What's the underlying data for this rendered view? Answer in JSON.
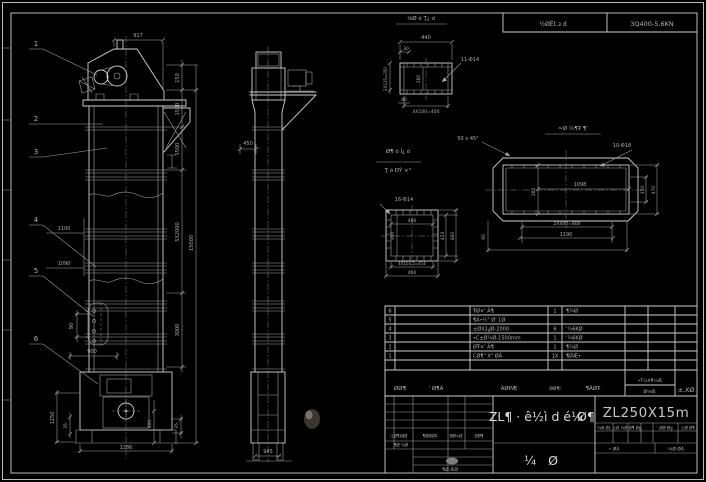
{
  "sheet": {
    "stamp": {
      "label": "½ØЁt.з d",
      "value": "3Q400-5.6KN"
    }
  },
  "front_view": {
    "balloons": [
      "1",
      "2",
      "3",
      "4",
      "5",
      "6"
    ],
    "dims": {
      "w917": "917",
      "h150": "150",
      "h1500a": "1500",
      "h1500b": "1500",
      "h5x2000": "5X2000",
      "h3000": "3000",
      "h15000": "15000",
      "d1100": "1100",
      "d1090": "1090",
      "d90": "90",
      "d900": "900",
      "d1250": "1250",
      "d35l": "35",
      "d1286": "1286",
      "d400": "400",
      "d35r": "35"
    }
  },
  "side_view": {
    "dims": {
      "d450": "450",
      "d945": "945"
    }
  },
  "channel_detail": {
    "title": "⅛Ø ó Ţ¿ d",
    "holes": "11-Φ14",
    "dims": {
      "d440": "440",
      "d30": "30",
      "d2x125": "2X125=250",
      "d260": "260",
      "d40": "40",
      "d4x100": "4X100=400"
    }
  },
  "flange_detail": {
    "label_top": "Ø¶ ó Ì¿ ó",
    "label_bottom": "Ţ ó ĐÝ ×°",
    "holes": "16-Φ14",
    "dims": {
      "d400": "400",
      "d390": "390",
      "d413": "413",
      "d460r": "460",
      "d4x1035": "4X103.5=414",
      "d460b": "460"
    }
  },
  "cover_detail": {
    "title": "≈Ø ½¶Ŧ ¶'",
    "chamfer": "50 x 45°",
    "holes": "10-Φ18",
    "dims": {
      "d1098": "1098",
      "d382": "382",
      "d150": "150",
      "d470": "470",
      "d2x400": "2X400=800",
      "d1190": "1190",
      "d95": "95"
    }
  },
  "bom": {
    "headers": {
      "h1": "ØØ¶",
      "h2": "' Ø¶Ã",
      "h3": "ÃØPÆ",
      "h4": "ØØ¶l",
      "h5": "¶ÃØŦ",
      "h6a": "•Ŧ¼X¶¼Æ",
      "h6b": "Ø¼Ø,",
      "h7": "±,XØ"
    },
    "rows": [
      {
        "no": "6",
        "desc": "ŦØ×' Ã¶",
        "qty": "1",
        "mat": "¶¼Ø"
      },
      {
        "no": "5",
        "desc": "¶Ã•½\" Ø' 1Ø",
        "qty": "",
        "mat": ""
      },
      {
        "no": "4",
        "desc": "±ØX2ؼØ-2000",
        "qty": "6",
        "mat": "'¼6KØ"
      },
      {
        "no": "3",
        "desc": "•C±Ø¼Ø-1500mm",
        "qty": "1",
        "mat": "'¼6KØ"
      },
      {
        "no": "2",
        "desc": "ØŦ×' Ã¶",
        "qty": "1",
        "mat": "¶¼Ø"
      },
      {
        "no": "1",
        "desc": "CØ¶\" X\" ØÃ",
        "qty": "1X",
        "mat": "¶ØÆ•"
      }
    ]
  },
  "title_block": {
    "name_main": "ZL¶ · ê½ì d é¼",
    "name_tail": "Ø¶",
    "model": "ZL250X15m",
    "drawing_type_left": "¼",
    "drawing_type_right": "Ø",
    "rev_headers": {
      "c1": "±Ø¶(ØØ",
      "c2": "¶ØØØÃ",
      "c3": "ØØ×Ø",
      "c4": "ØØ¶"
    },
    "rev_row2": "¶Ø ¼Ø",
    "approve": "¶Ø ÆØ",
    "small_labels": [
      "¼Ø ØL",
      "±Ø ¼Ø",
      "Ø¶ Øg",
      "ØØ Øg",
      "±Ø Ø¶"
    ],
    "stage_left": "• ØÃ",
    "stage_right": "¼Ø ØÃ"
  }
}
